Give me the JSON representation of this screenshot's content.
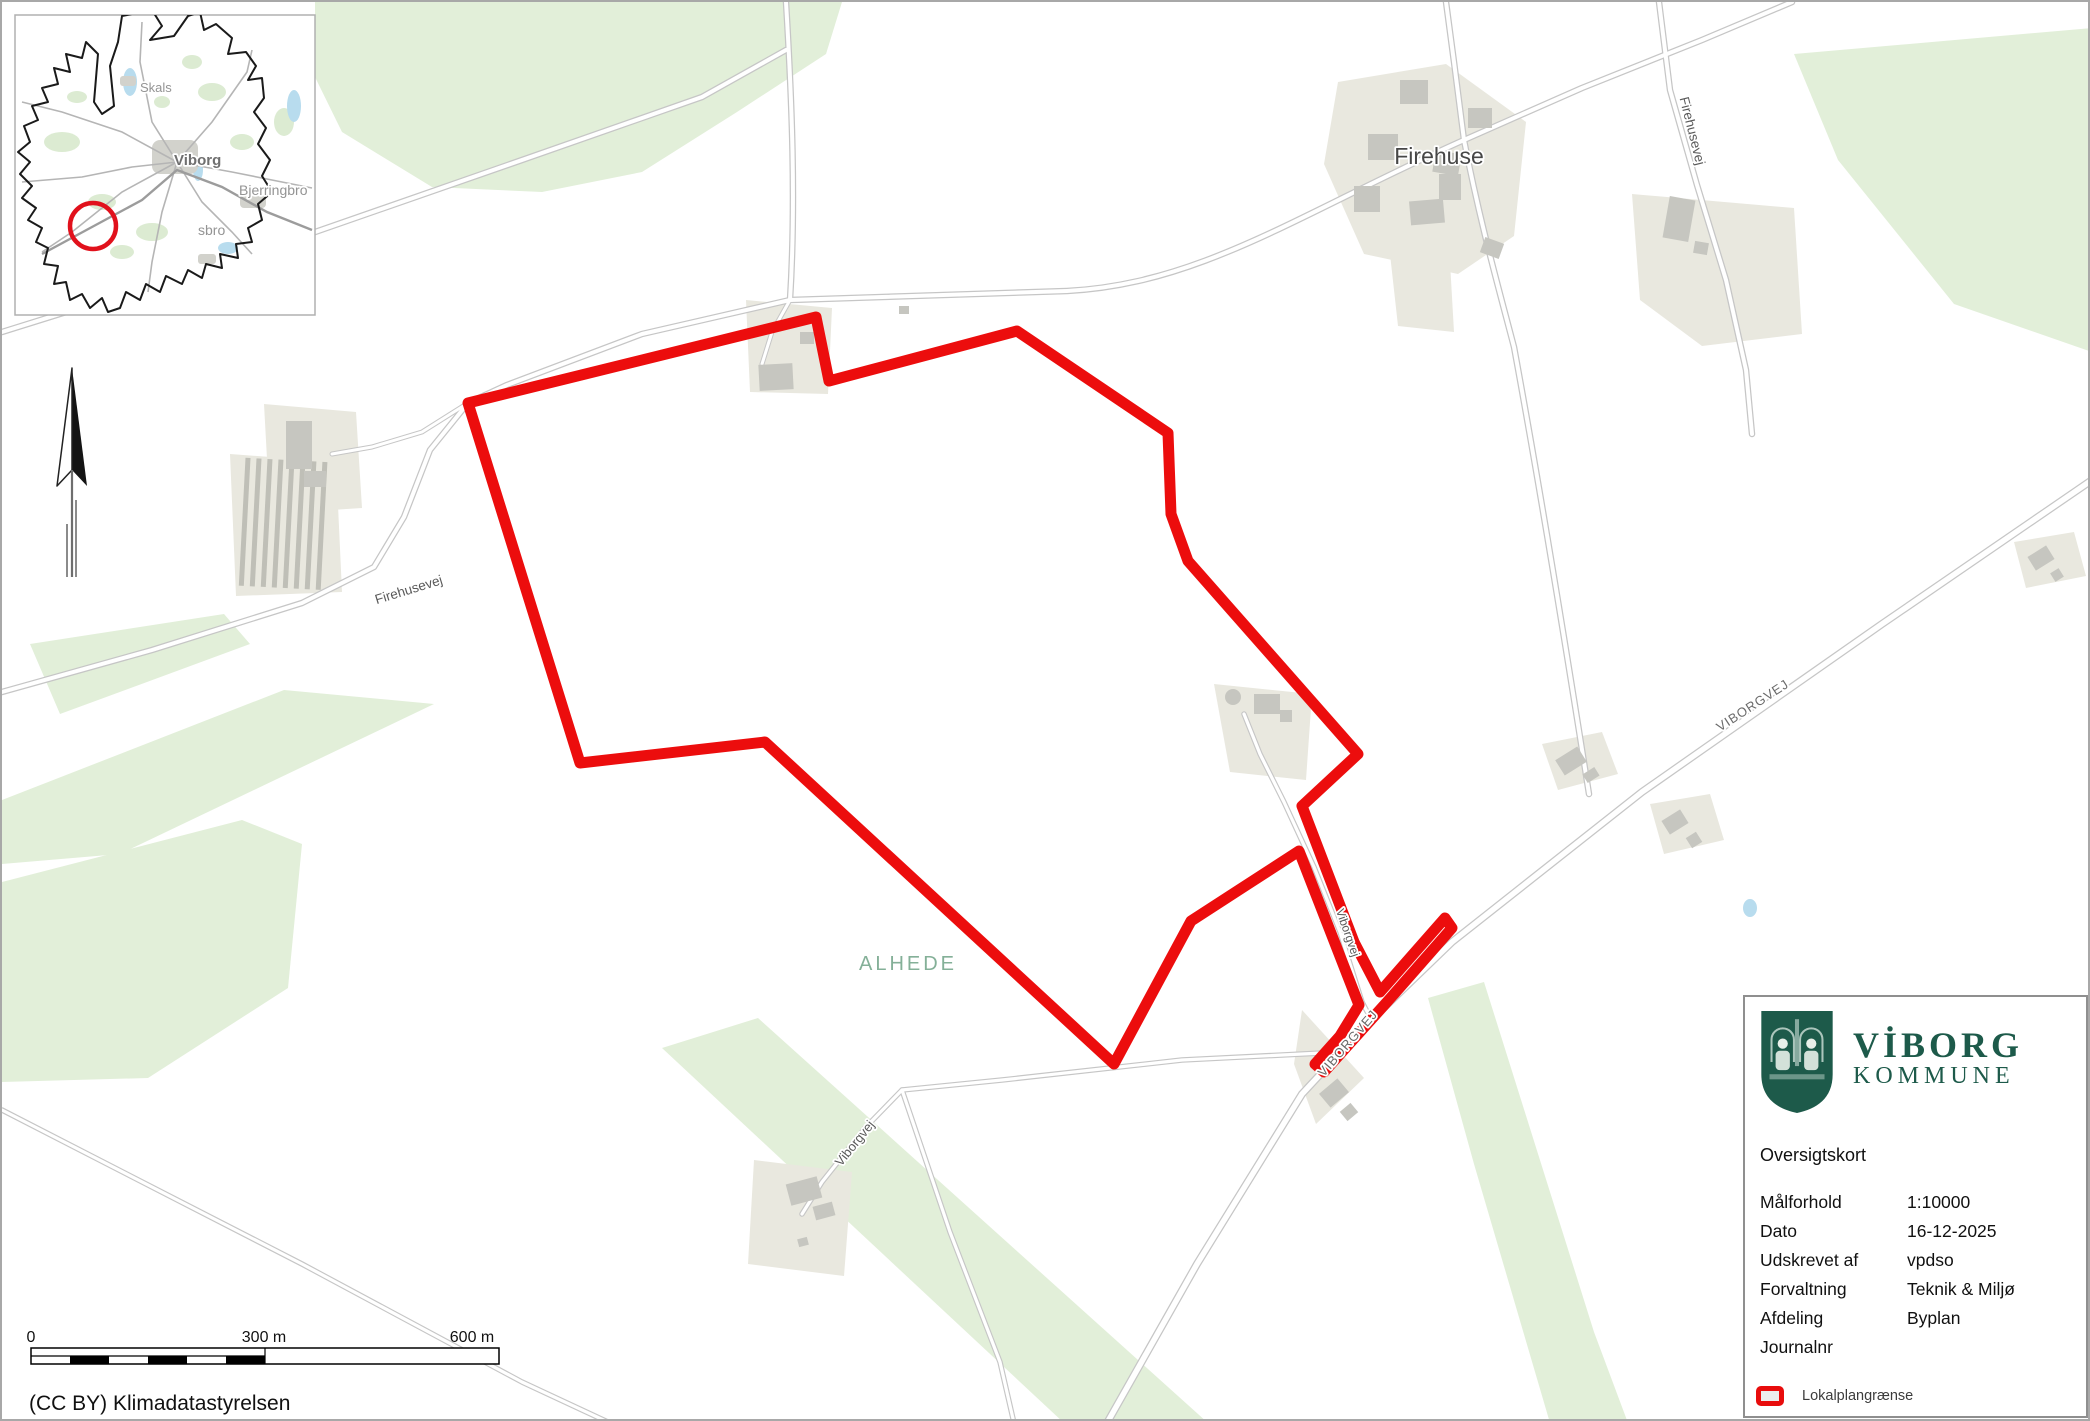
{
  "colors": {
    "boundary_red": "#ec0d0d",
    "legend_red": "#e80c0c",
    "logo_green": "#1d5a4a",
    "map_green": "#e2efd9",
    "parcel_beige": "#e9e8df",
    "building_gray": "#c6c6c0",
    "road_casing_gray": "#c6c6c6",
    "area_label_green": "#84b098",
    "inset_circle_red": "#e1111c"
  },
  "inset": {
    "labels": {
      "skals": "Skals",
      "viborg": "Viborg",
      "bjerringbro": "Bjerringbro",
      "sbro": "sbro"
    }
  },
  "map_labels": {
    "firehuse": "Firehuse",
    "firehusevej_w": "Firehusevej",
    "firehusevej_e": "Firehusevej",
    "viborgvej_hw_upper": "VIBORGVEJ",
    "viborgvej_hw_lower": "VIBORGVEJ",
    "viborgvej_corridor": "Viborgvej",
    "viborgvej_sw": "Viborgvej",
    "alhede": "ALHEDE"
  },
  "scalebar": {
    "t0": "0",
    "t300": "300 m",
    "t600": "600 m"
  },
  "attribution": "(CC BY) Klimadatastyrelsen",
  "infobox": {
    "brand_line1": "VİBORG",
    "brand_line2": "KOMMUNE",
    "title": "Oversigtskort",
    "rows": [
      {
        "label": "Målforhold",
        "value": "1:10000"
      },
      {
        "label": "Dato",
        "value": "16-12-2025"
      },
      {
        "label": "Udskrevet af",
        "value": "vpdso"
      },
      {
        "label": "Forvaltning",
        "value": "Teknik & Miljø"
      },
      {
        "label": "Afdeling",
        "value": "Byplan"
      },
      {
        "label": "Journalnr",
        "value": ""
      }
    ],
    "legend": {
      "label": "Lokalplangrænse"
    }
  }
}
